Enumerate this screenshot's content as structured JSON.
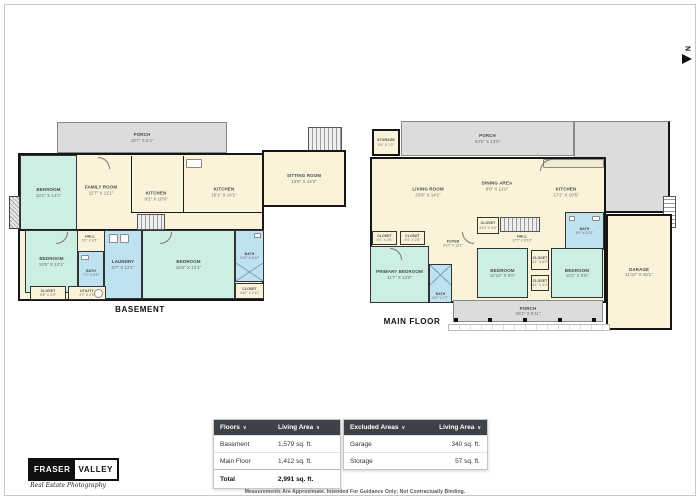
{
  "north": {
    "label": "N"
  },
  "basement": {
    "title": "BASEMENT",
    "porch": {
      "name": "PORCH",
      "dims": "43'7\" X 8'4\""
    },
    "sitting": {
      "name": "SITTING ROOM",
      "dims": "10'8\" X 14'3\""
    },
    "bedroom_tl": {
      "name": "BEDROOM",
      "dims": "10'1\" X 14'1\""
    },
    "family": {
      "name": "FAMILY ROOM",
      "dims": "11'7\" X 11'1\""
    },
    "kitchen_a": {
      "name": "KITCHEN",
      "dims": "9'2\" X 10'9\""
    },
    "kitchen_b": {
      "name": "KITCHEN",
      "dims": "16'1\" X 14'1\""
    },
    "bedroom_bl": {
      "name": "BEDROOM",
      "dims": "10'5\" X 12'1\""
    },
    "hall": {
      "name": "HALL",
      "dims": "5'1\" X 6'1\""
    },
    "bath_a": {
      "name": "BATH",
      "dims": "7'1\" X 8'0\""
    },
    "laundry": {
      "name": "LAUNDRY",
      "dims": "6'7\" X 12'1\""
    },
    "bedroom_br": {
      "name": "BEDROOM",
      "dims": "18'3\" X 12'1\""
    },
    "bath_b": {
      "name": "BATH",
      "dims": "4'10\" X 9'10\""
    },
    "closet_br": {
      "name": "CLOSET",
      "dims": "4'10\" X 2'11\""
    },
    "closet_bl": {
      "name": "CLOSET",
      "dims": "6'8\" X 2'9\""
    },
    "utility": {
      "name": "UTILITY",
      "dims": "4'7\" X 2'9\""
    }
  },
  "main_floor": {
    "title": "MAIN FLOOR",
    "storage": {
      "name": "STORAGE",
      "dims": "6'4\" X 7'0\""
    },
    "porch_top": {
      "name": "PORCH",
      "dims": "53'1\" X 13'5\""
    },
    "living": {
      "name": "LIVING ROOM",
      "dims": "23'8\" X 14'1\""
    },
    "dining": {
      "name": "DINING AREA",
      "dims": "8'0\" X 11'0\""
    },
    "kitchen": {
      "name": "KITCHEN",
      "dims": "17'2\" X 10'5\""
    },
    "bath_main": {
      "name": "BATH",
      "dims": "8'0\" X 5'10\""
    },
    "hall": {
      "name": "HALL",
      "dims": "17'7\" X 5'10\""
    },
    "closet_stairs": {
      "name": "CLOSET",
      "dims": "4'10\" X 4'0\""
    },
    "closet_a": {
      "name": "CLOSET",
      "dims": "5'4\" X 2'5\""
    },
    "closet_b": {
      "name": "CLOSET",
      "dims": "5'4\" X 2'5\""
    },
    "foyer": {
      "name": "FOYER",
      "dims": "9'10\" X 13'1\""
    },
    "primary": {
      "name": "PRIMARY BEDROOM",
      "dims": "11'7\" X 13'0\""
    },
    "bath_ensuite": {
      "name": "BATH",
      "dims": "5'0\" X 7'7\""
    },
    "bedroom_mid": {
      "name": "BEDROOM",
      "dims": "10'10\" X 9'0\""
    },
    "closet_mid_top": {
      "name": "CLOSET",
      "dims": "4'1\" X 6'0\""
    },
    "closet_mid_bot": {
      "name": "CLOSET",
      "dims": "4'1\" X 4'4\""
    },
    "bedroom_right": {
      "name": "BEDROOM",
      "dims": "11'5\" X 9'5\""
    },
    "garage": {
      "name": "GARAGE",
      "dims": "11'10\" X 26'1\""
    },
    "porch_bottom": {
      "name": "PORCH",
      "dims": "50'4\" X 6'11\""
    }
  },
  "tables": {
    "floors": {
      "col1": "Floors",
      "col2": "Living Area",
      "sort_icon": "∨",
      "rows": [
        {
          "label": "Basement",
          "value": "1,579 sq. ft."
        },
        {
          "label": "Main Floor",
          "value": "1,412 sq. ft."
        }
      ],
      "total": {
        "label": "Total",
        "value": "2,991 sq. ft."
      }
    },
    "excluded": {
      "col1": "Excluded Areas",
      "col2": "Living Area",
      "sort_icon": "∨",
      "rows": [
        {
          "label": "Garage",
          "value": "340 sq. ft."
        },
        {
          "label": "Storage",
          "value": "57 sq. ft."
        }
      ]
    }
  },
  "disclaimer": "Measurements Are Approximate. Intended For Guidance Only; Not Contractually Binding.",
  "logo": {
    "name_left": "FRASER",
    "name_right": "VALLEY",
    "tagline": "Real Estate Photography"
  },
  "colors": {
    "room_cream": "#faf3da",
    "room_teal": "#cdeee2",
    "room_blue": "#bfe2f0",
    "porch_gray": "#dcdcdc",
    "wall": "#1a1a1a",
    "table_header_bg": "#3d4248"
  }
}
